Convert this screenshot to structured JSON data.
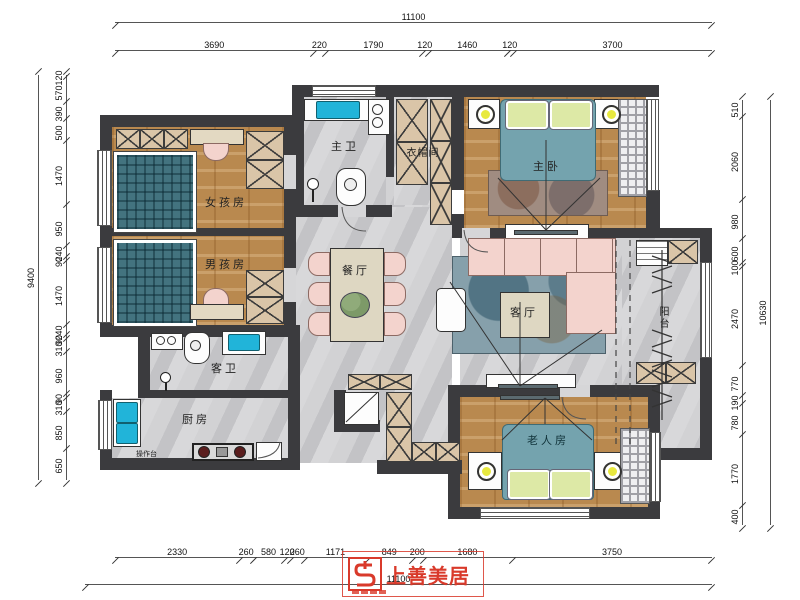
{
  "title": "三室两厅户型平面布置图",
  "rooms": {
    "master_bath": "主卫",
    "cloakroom": "衣帽间",
    "master_bedroom": "主卧",
    "girls_room": "女孩房",
    "boys_room": "男孩房",
    "dining": "餐厅",
    "living": "客厅",
    "guest_bath": "客卫",
    "kitchen": "厨房",
    "elderly_room": "老人房",
    "balcony": "阳台",
    "worktop": "操作台"
  },
  "dims": {
    "top": {
      "total": "11100",
      "segments": [
        "3690",
        "220",
        "1790",
        "120",
        "1460",
        "120",
        "3700"
      ]
    },
    "bottom": {
      "total": "11100",
      "segments": [
        "2330",
        "260",
        "580",
        "120",
        "260",
        "1171",
        "849",
        "200",
        "1680",
        "3750"
      ]
    },
    "left": {
      "total": "9400",
      "segments": [
        "120",
        "570",
        "390",
        "500",
        "1470",
        "950",
        "240",
        "90",
        "1470",
        "240",
        "90",
        "310",
        "960",
        "90",
        "310",
        "850",
        "650"
      ]
    },
    "right": {
      "total": "10630",
      "segments": [
        "510",
        "2060",
        "980",
        "600",
        "100",
        "2470",
        "770",
        "190",
        "780",
        "1770",
        "400"
      ]
    }
  },
  "logo": {
    "brand": "上善美居"
  },
  "colors": {
    "wall": "#3b3b3e",
    "wood_floor": "#b9894f",
    "marble_floor": "#cbcbcd",
    "tatami_teal": "#43737f",
    "bed_teal": "#74a3ae",
    "sofa_pink": "#f3d3cd",
    "sink_cyan": "#21b4d9",
    "pillow_green": "#dde9a6",
    "lamp_yellow": "#e8e93f",
    "cabinet_beige": "#dac5a8",
    "stamp_red": "#d93a2b"
  }
}
